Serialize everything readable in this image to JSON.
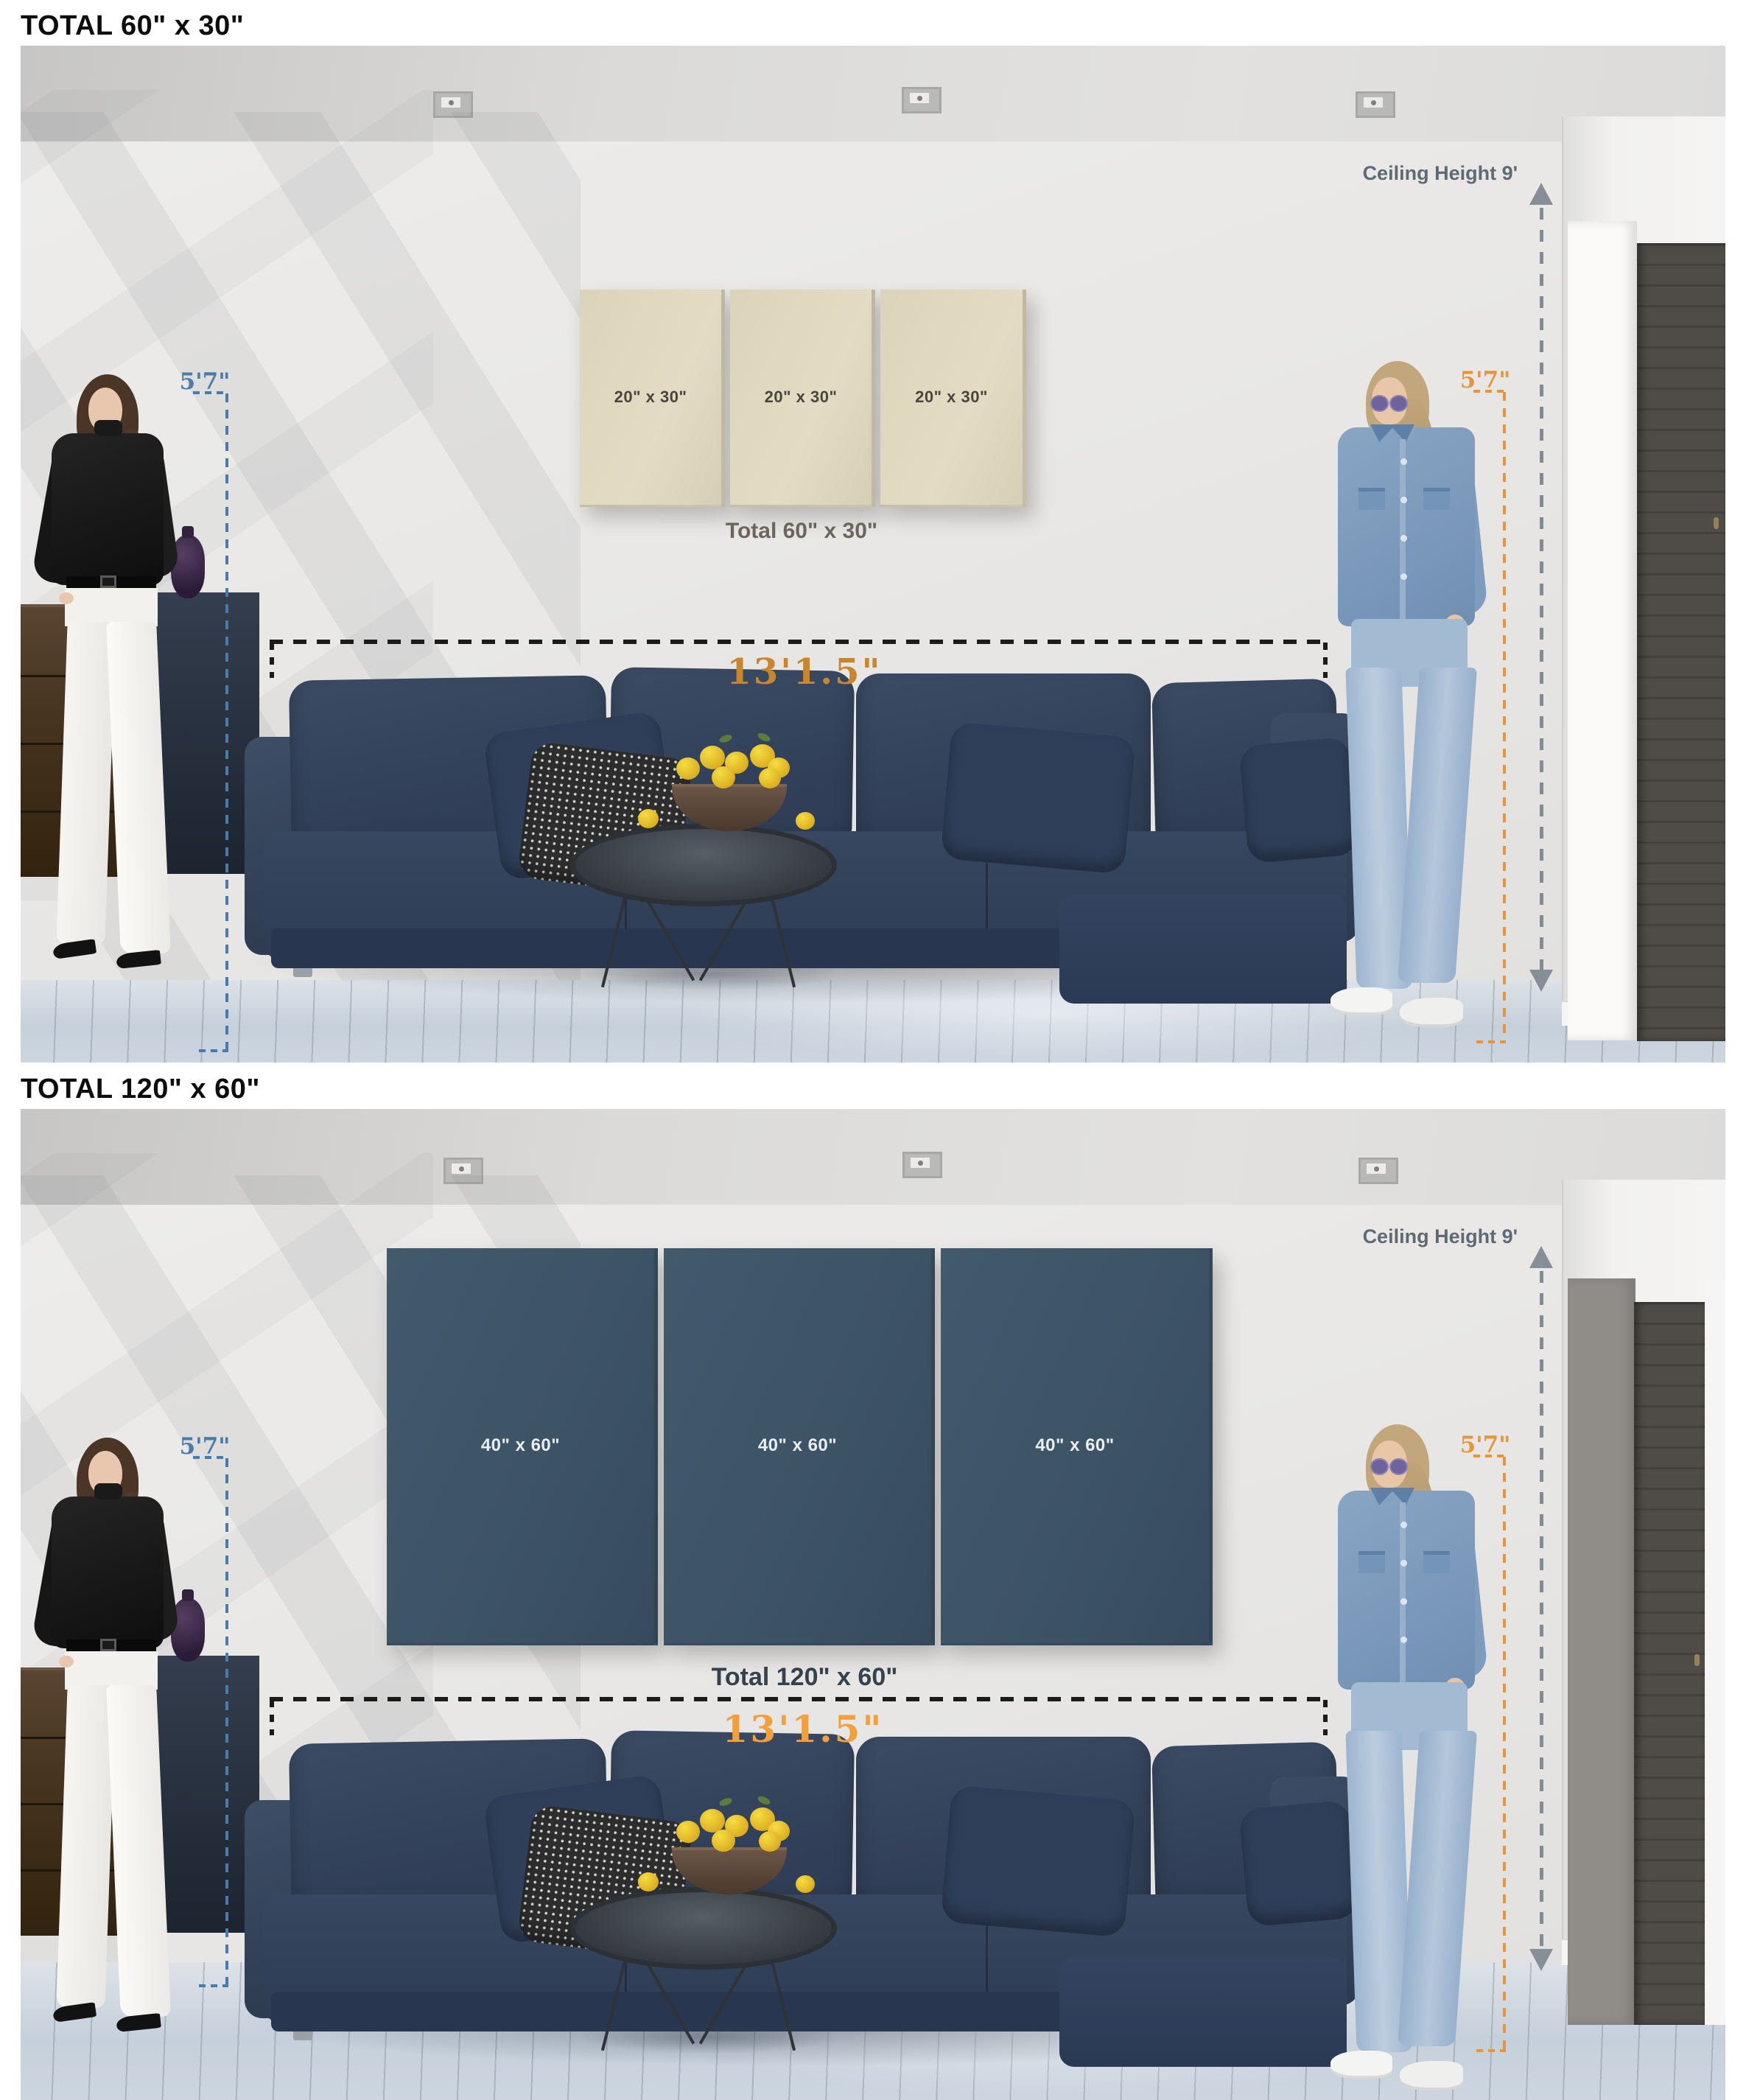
{
  "colors": {
    "accent_blue": "#4a7cab",
    "accent_orange": "#e5953c",
    "dim_orange_a": "#c8872e",
    "dim_orange_b": "#f0a13e",
    "gray_annotation": "#5e6a74",
    "canvas_beige": "#dcd4ba",
    "canvas_navy": "#3d5366",
    "dash_black": "#1b1b1b",
    "total_a_color": "#6b655c",
    "total_b_color": "#33424d"
  },
  "sections": [
    {
      "header": "TOTAL 60\" x 30\"",
      "canvas_labels": [
        "20\" x 30\"",
        "20\" x 30\"",
        "20\" x 30\""
      ],
      "total_label": "Total 60\" x 30\"",
      "ceiling_label": "Ceiling Height 9'",
      "left_height_label": "5'7\"",
      "right_height_label": "5'7\"",
      "width_label": "13'1.5\""
    },
    {
      "header": "TOTAL 120\" x 60\"",
      "canvas_labels": [
        "40\" x 60\"",
        "40\" x 60\"",
        "40\" x 60\""
      ],
      "total_label": "Total 120\" x 60\"",
      "ceiling_label": "Ceiling Height 9'",
      "left_height_label": "5'7\"",
      "right_height_label": "5'7\"",
      "width_label": "13'1.5\""
    }
  ]
}
